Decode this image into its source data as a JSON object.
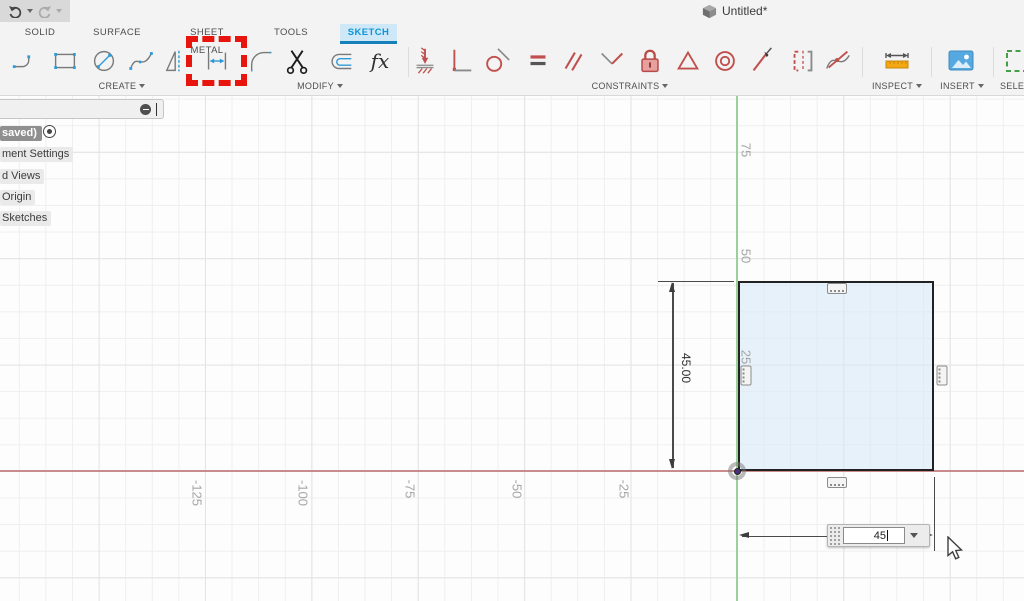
{
  "titlebar": {
    "title": "Untitled*"
  },
  "tabs": {
    "solid": "SOLID",
    "surface": "SURFACE",
    "sheet_metal": "SHEET METAL",
    "tools": "TOOLS",
    "sketch": "SKETCH",
    "active_tab": "SKETCH"
  },
  "toolbar": {
    "groups": {
      "create": "CREATE",
      "modify": "MODIFY",
      "constraints": "CONSTRAINTS",
      "inspect": "INSPECT",
      "insert": "INSERT",
      "select": "SELECT"
    },
    "icons": {
      "create": [
        "line-tool",
        "rectangle-tool",
        "circle-tool",
        "spline-tool",
        "mirror-tool",
        "sketch-dimension-tool",
        "fillet-tool",
        "trim-tool",
        "offset-tool",
        "function-fx-tool"
      ],
      "constraints": [
        "coincident",
        "horizontal-vertical",
        "tangent",
        "equal",
        "parallel",
        "perpendicular",
        "fix-lock",
        "midpoint",
        "concentric",
        "smooth",
        "symmetry",
        "curvature"
      ],
      "inspect": [
        "measure"
      ],
      "insert": [
        "insert-image"
      ],
      "select": [
        "select-window"
      ]
    },
    "highlighted_tool": "sketch-dimension-tool"
  },
  "browser": {
    "root_label": "saved)",
    "items": [
      "ment Settings",
      "d Views",
      "Origin",
      "Sketches"
    ]
  },
  "canvas": {
    "y_axis_labels": [
      "75",
      "50",
      "25"
    ],
    "x_axis_labels": [
      "-125",
      "-100",
      "-75",
      "-50",
      "-25"
    ],
    "colors": {
      "x_axis": "#c98b8b",
      "y_axis": "#9ccf9a",
      "sketch_fill": "#dfeefb",
      "accent_blue": "#0696d7",
      "highlight_red": "#e8150f"
    }
  },
  "sketch": {
    "vertical_dimension": "45.00",
    "input_value": "45"
  }
}
